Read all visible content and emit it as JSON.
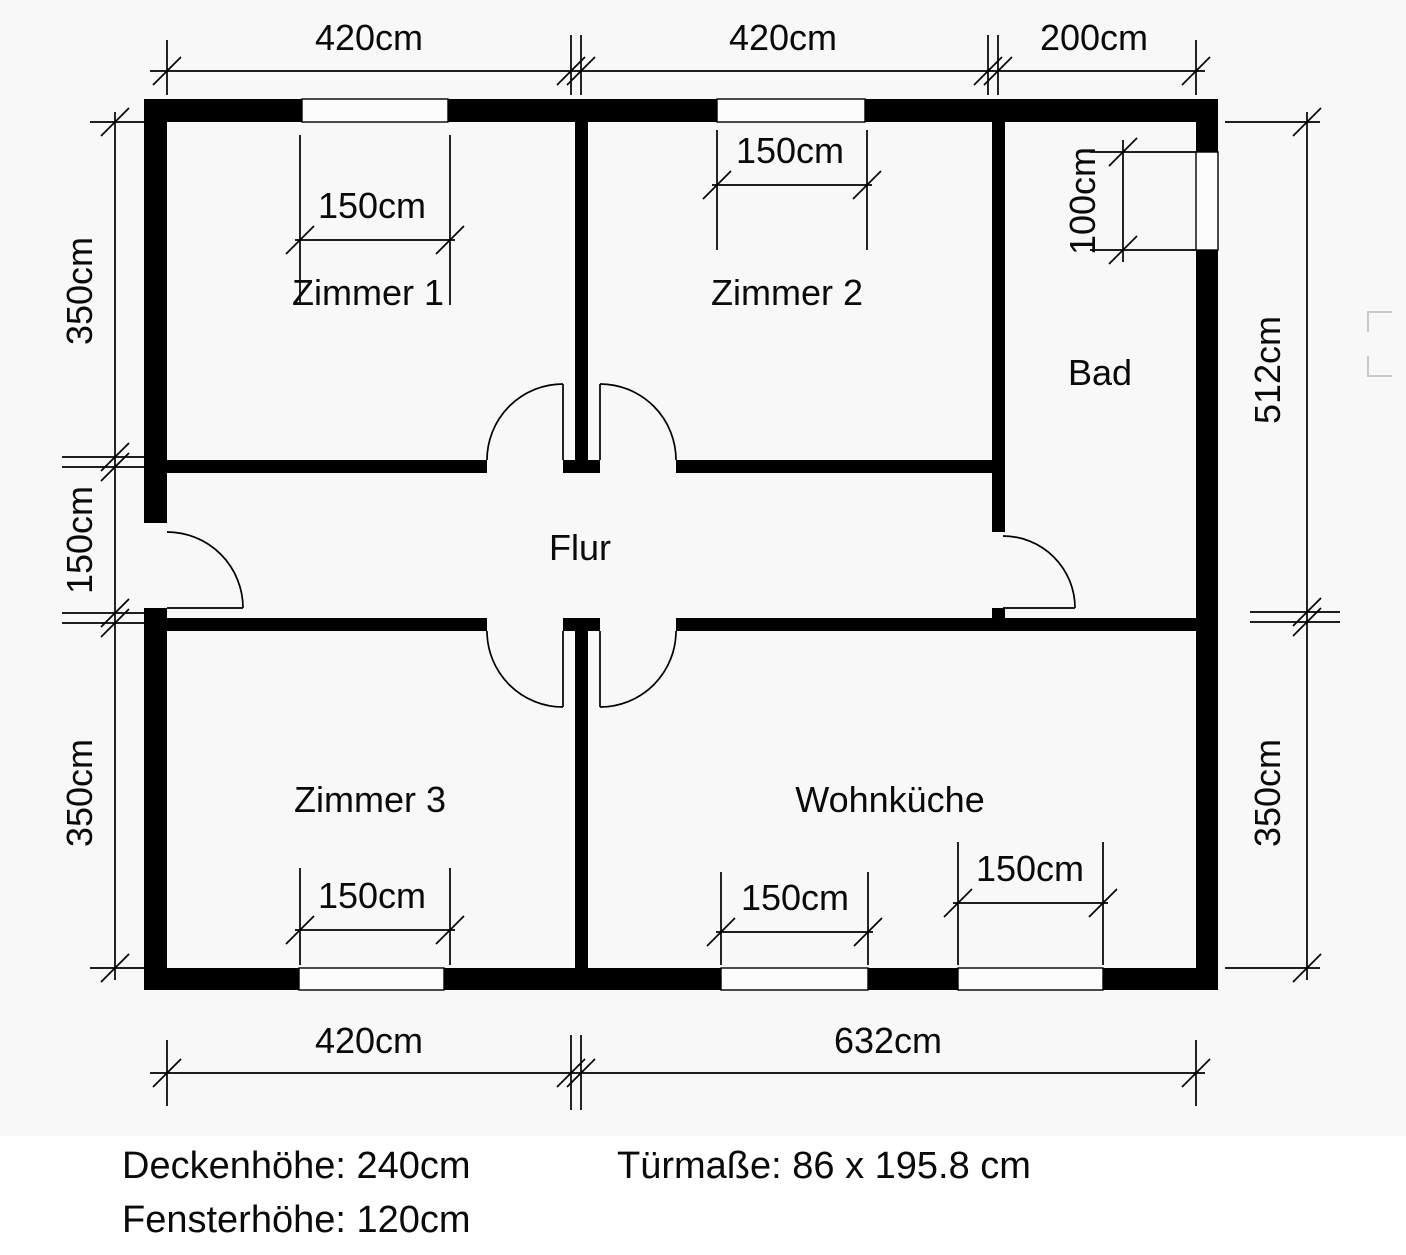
{
  "rooms": {
    "zimmer1": "Zimmer 1",
    "zimmer2": "Zimmer 2",
    "bad": "Bad",
    "flur": "Flur",
    "zimmer3": "Zimmer 3",
    "wohnkueche": "Wohnküche"
  },
  "dims": {
    "top_left_width": "420cm",
    "top_mid_width": "420cm",
    "top_right_width": "200cm",
    "bottom_left_width": "420cm",
    "bottom_right_width": "632cm",
    "left_top_height": "350cm",
    "left_mid_height": "150cm",
    "left_bottom_height": "350cm",
    "right_top_height": "512cm",
    "right_bottom_height": "350cm",
    "window_zimmer1": "150cm",
    "window_zimmer2": "150cm",
    "window_zimmer3": "150cm",
    "window_wohnkueche_left": "150cm",
    "window_wohnkueche_right": "150cm",
    "window_bad": "100cm"
  },
  "notes": {
    "ceiling_height": "Deckenhöhe: 240cm",
    "window_height": "Fensterhöhe: 120cm",
    "door_size": "Türmaße: 86 x 195.8 cm"
  },
  "colors": {
    "wall": "#000000",
    "plan_background": "#f8f8f8",
    "paper": "#ffffff",
    "faint_mark": "#c9c9c9"
  }
}
